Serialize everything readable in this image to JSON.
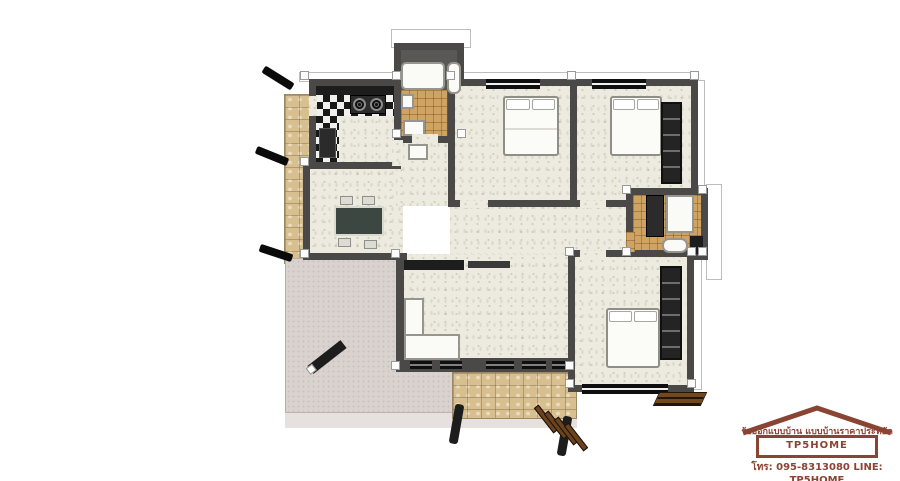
{
  "branding": {
    "tagline": "รับออกแบบบ้าน แบบบ้านราคาประหยัด",
    "brand": "TP5HOME",
    "contact": "โทร: 095-8313080  LINE: TP5HOME",
    "text_color": "#8a4434"
  },
  "palette": {
    "wall": "#4a4947",
    "interior_floor": "#edebe0",
    "bathroom_tile": "#cfa462",
    "stone_path": "#d8bf90",
    "terrace": "#d9d2cf",
    "furniture_white": "#fafaf7",
    "furniture_dark": "#1d1d1d",
    "wood_steps": "#6b441f",
    "background": "#ffffff"
  },
  "plan": {
    "type": "single-storey house floor plan, top-down 3D render",
    "rooms": [
      {
        "name": "kitchen",
        "furniture": [
          "l-shaped-checkered-counter",
          "two-burner-stove",
          "sink-appliance"
        ]
      },
      {
        "name": "bathroom-top",
        "furniture": [
          "bathtub",
          "toilet",
          "sink",
          "mat"
        ]
      },
      {
        "name": "bedroom-top-middle",
        "furniture": [
          "double-bed",
          "window-top"
        ]
      },
      {
        "name": "bedroom-top-right",
        "furniture": [
          "double-bed",
          "wardrobe",
          "window-top"
        ]
      },
      {
        "name": "bathroom-right",
        "furniture": [
          "vanity",
          "shower",
          "toilet"
        ]
      },
      {
        "name": "bedroom-bottom-right",
        "furniture": [
          "double-bed",
          "wardrobe",
          "window-bottom",
          "wood-steps"
        ]
      },
      {
        "name": "living-dining-hall",
        "furniture": [
          "dining-table",
          "four-chairs",
          "tv-cabinet",
          "l-shaped-sofa",
          "wash-basin",
          "window-band"
        ]
      },
      {
        "name": "terrace",
        "furniture": [
          "bench"
        ]
      },
      {
        "name": "entry-patio",
        "furniture": [
          "wood-steps",
          "two-posts"
        ]
      },
      {
        "name": "side-walkway",
        "furniture": []
      }
    ],
    "entry_arrow_count": 3
  }
}
